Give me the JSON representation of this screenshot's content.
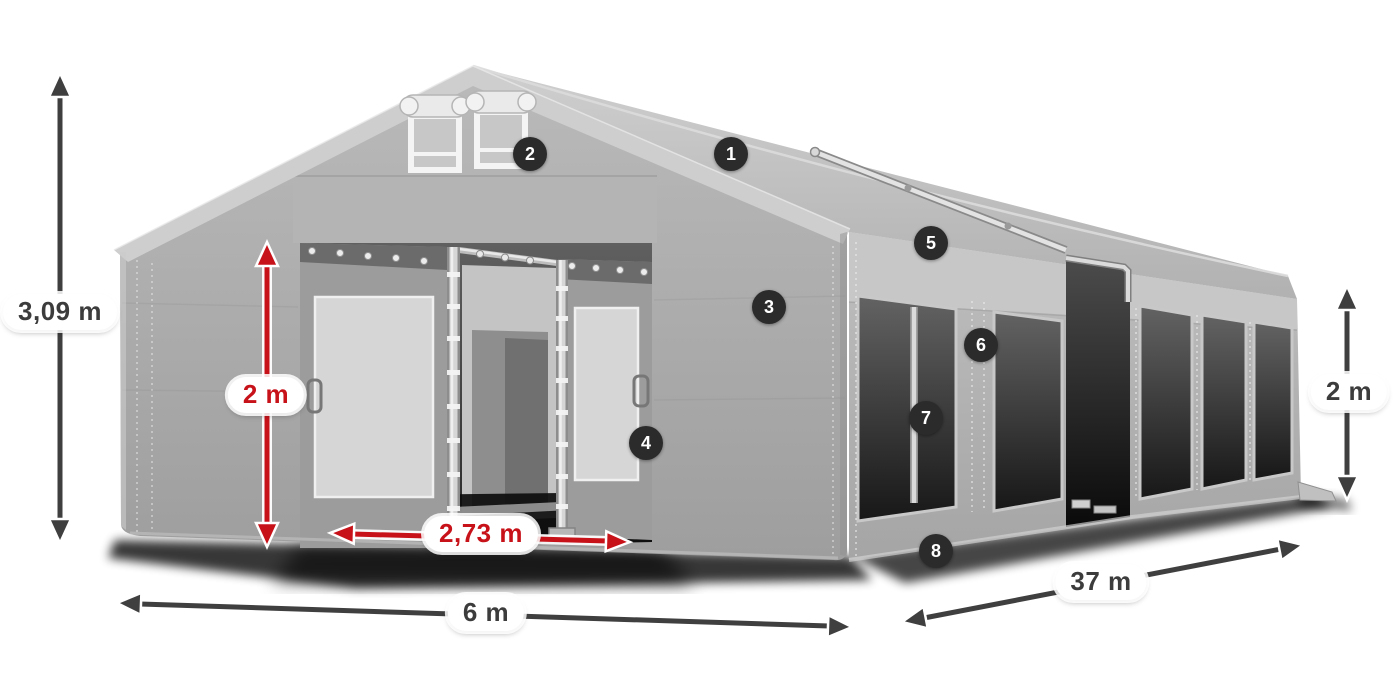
{
  "diagram_type": "tent-product-dimension-diagram",
  "dimensions": {
    "total_height": "3,09 m",
    "entrance_height": "2 m",
    "entrance_width": "2,73 m",
    "front_width": "6 m",
    "side_length": "37 m",
    "side_wall_height": "2 m"
  },
  "markers": [
    {
      "number": "1"
    },
    {
      "number": "2"
    },
    {
      "number": "3"
    },
    {
      "number": "4"
    },
    {
      "number": "5"
    },
    {
      "number": "6"
    },
    {
      "number": "7"
    },
    {
      "number": "8"
    }
  ],
  "colors": {
    "background": "#ffffff",
    "tent_wall_gray": "#a8a8a8",
    "tent_roof_gray": "#c6c6c6",
    "window_dark": "#2a2a2a",
    "dimension_arrow_dark": "#3f3f3f",
    "dimension_accent_red": "#c8121a",
    "marker_background": "#2b2b2b",
    "marker_text": "#ffffff"
  }
}
